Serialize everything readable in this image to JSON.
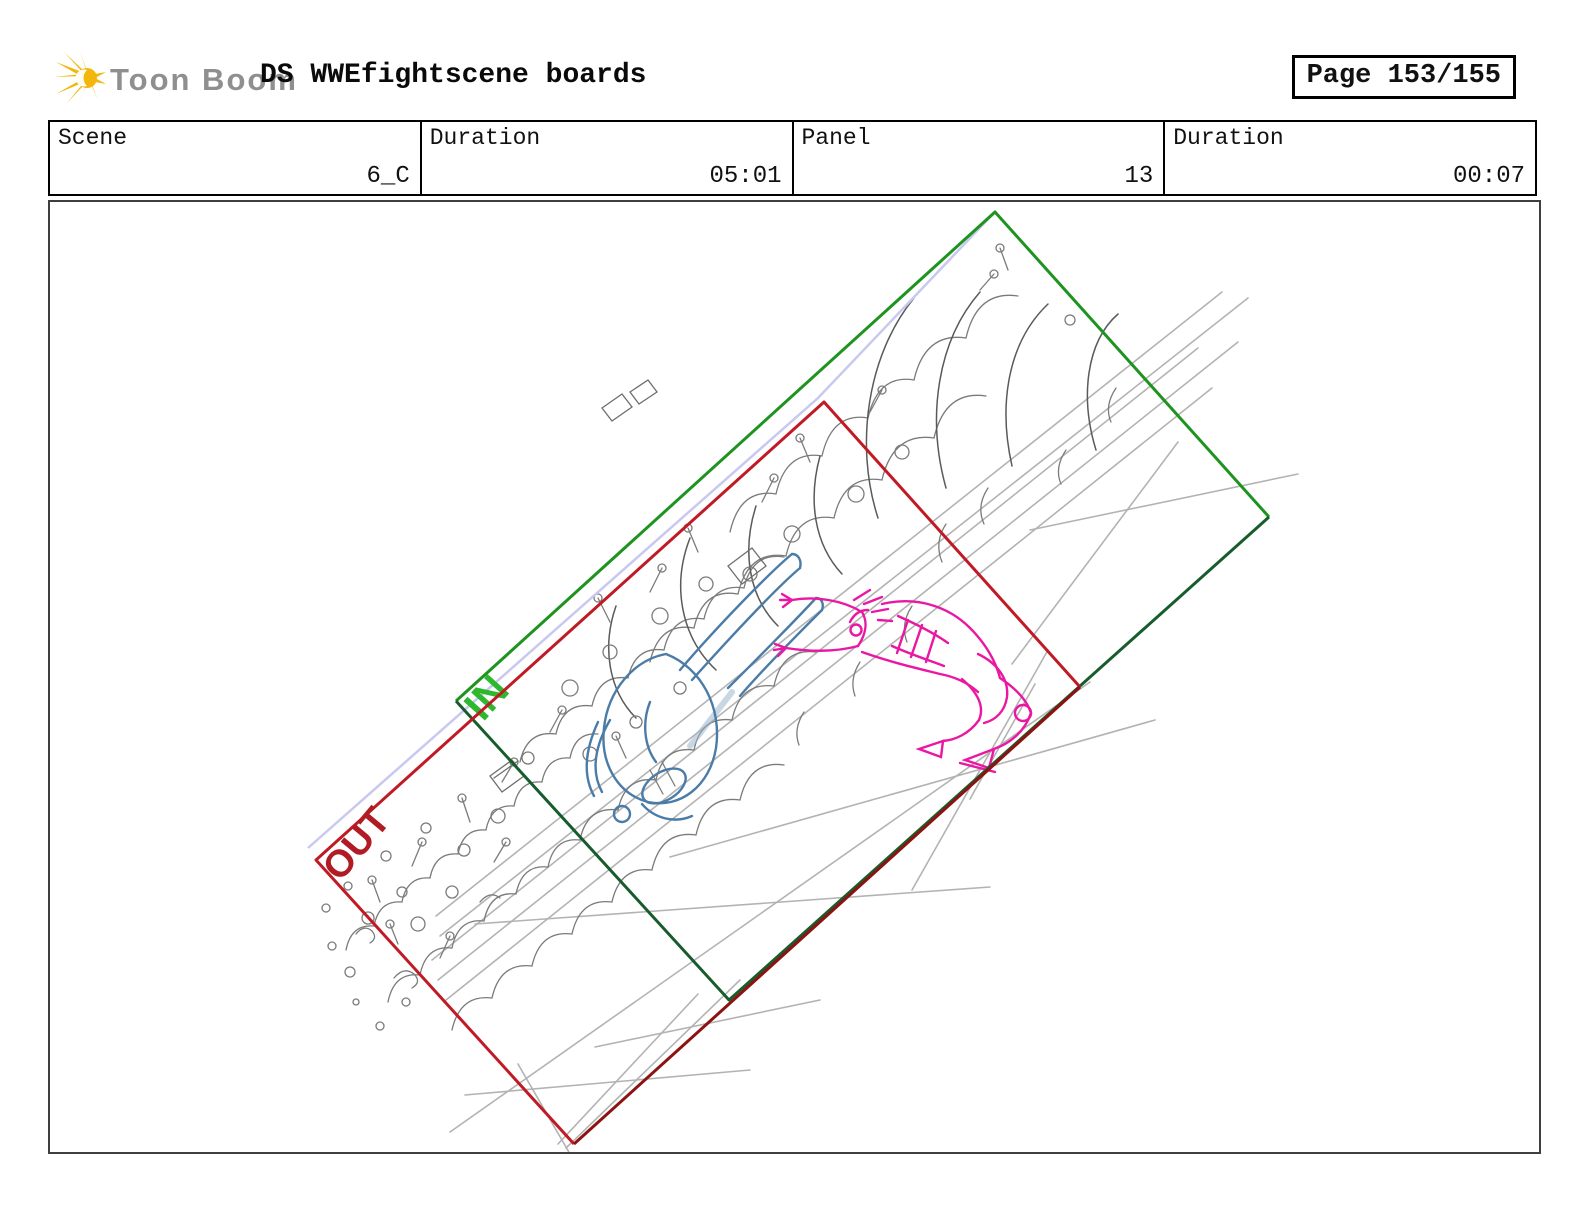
{
  "header": {
    "brand": "Toon Boom",
    "title": "DS WWEfightscene boards",
    "page_label": "Page 153/155"
  },
  "info_table": {
    "cells": [
      {
        "label": "Scene",
        "value": "6_C"
      },
      {
        "label": "Duration",
        "value": "05:01"
      },
      {
        "label": "Panel",
        "value": "13"
      },
      {
        "label": "Duration",
        "value": "00:07"
      }
    ]
  },
  "panel": {
    "in_label": "IN",
    "out_label": "OUT"
  },
  "colors": {
    "frame_in_bright": "#1f9320",
    "frame_in_dark": "#175c2c",
    "frame_out_bright": "#c01a25",
    "frame_out_dark": "#8c1312",
    "label_in": "#2eb82e",
    "label_out": "#b01b24",
    "camera_path": "#c9c9f0",
    "figure_blue": "#4b7ca8",
    "figure_blue_soft": "#9cb6d0",
    "figure_magenta": "#ea17a2",
    "sketch_gray": "#7b7b7b",
    "sketch_gray_light": "#b3b3b3",
    "logo_gold": "#f2b70a"
  }
}
